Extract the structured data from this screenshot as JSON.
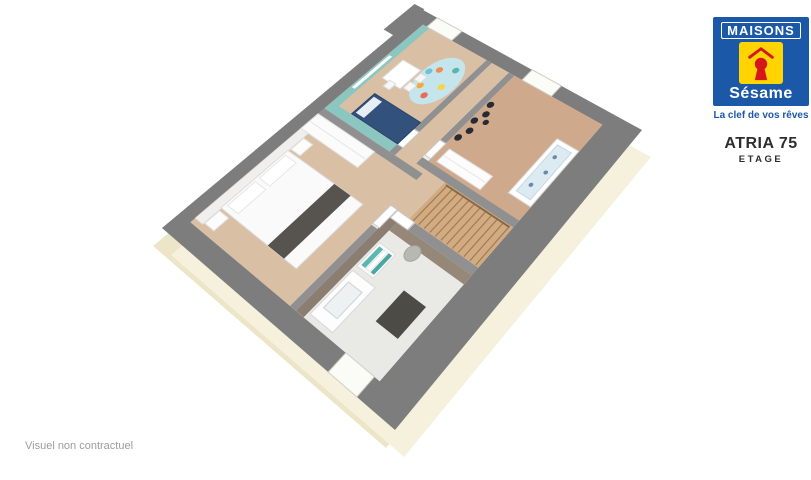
{
  "branding": {
    "maisons": "MAISONS",
    "sesame": "Sésame",
    "tagline": "La clef de vos rêves",
    "blue": "#1b59a8",
    "yellow": "#ffd400",
    "red": "#d6161d"
  },
  "model": {
    "name": "ATRIA 75",
    "level": "ETAGE"
  },
  "footer": {
    "disclaimer": "Visuel non contractuel"
  },
  "floorplan": {
    "canvas": {
      "width": 811,
      "height": 480
    },
    "projection": {
      "corners": {
        "A": [
          162,
          228
        ],
        "B": [
          423,
          10
        ],
        "C": [
          642,
          130
        ],
        "D": [
          395,
          430
        ]
      }
    },
    "shapes": [
      {
        "name": "facade-left-strip",
        "type": "quad-offset",
        "dx": -9,
        "dy": 18,
        "fill": "#ece5c8"
      },
      {
        "name": "facade-bottom-strip",
        "type": "quad-offset",
        "dx": 9,
        "dy": 27,
        "fill": "#f5f1dd"
      },
      {
        "name": "exterior-wall-band",
        "type": "rect",
        "u0": 0,
        "v0": 0,
        "u1": 1,
        "v1": 1,
        "fill": "#7d7d7d"
      },
      {
        "name": "exterior-wall-notch",
        "type": "rect",
        "u0": 0.86,
        "v0": -0.05,
        "u1": 1.005,
        "v1": 0.002,
        "fill": "#7d7d7d"
      },
      {
        "name": "floor-base",
        "type": "rect",
        "u0": 0.055,
        "v0": 0.055,
        "u1": 0.95,
        "v1": 0.88,
        "fill": "#ececea"
      },
      {
        "name": "master-bedroom-floor",
        "type": "rect",
        "u0": 0.055,
        "v0": 0.055,
        "u1": 0.5,
        "v1": 0.52,
        "fill": "#d9c0a5"
      },
      {
        "name": "master-headboard-wall",
        "type": "rect",
        "u0": 0.07,
        "v0": 0.055,
        "u1": 0.435,
        "v1": 0.092,
        "fill": "#f0efed",
        "stroke": "#e2e0dd",
        "w": 0.8
      },
      {
        "name": "kids-bedroom-floor",
        "type": "rect",
        "u0": 0.525,
        "v0": 0.055,
        "u1": 0.95,
        "v1": 0.37,
        "fill": "#d9c0a5"
      },
      {
        "name": "hallway-floor",
        "type": "rect",
        "u0": 0.525,
        "v0": 0.395,
        "u1": 0.95,
        "v1": 0.475,
        "fill": "#d9c0a5"
      },
      {
        "name": "landing-floor",
        "type": "rect",
        "u0": 0.4,
        "v0": 0.475,
        "u1": 0.565,
        "v1": 0.6,
        "fill": "#d9c0a5"
      },
      {
        "name": "nursery-floor",
        "type": "rect",
        "u0": 0.565,
        "v0": 0.5,
        "u1": 0.95,
        "v1": 0.88,
        "fill": "#cfa98b"
      },
      {
        "name": "bathroom-floor",
        "type": "rect",
        "u0": 0.055,
        "v0": 0.545,
        "u1": 0.375,
        "v1": 0.88,
        "fill": "#e9e9e6"
      },
      {
        "name": "staircase-floor",
        "type": "rect",
        "u0": 0.4,
        "v0": 0.6,
        "u1": 0.54,
        "v1": 0.88,
        "fill": "#d2ab82"
      },
      {
        "name": "kids-teal-wall-top",
        "type": "rect",
        "u0": 0.525,
        "v0": 0.055,
        "u1": 0.95,
        "v1": 0.088,
        "fill": "#8cc6c1"
      },
      {
        "name": "kids-teal-wall-side",
        "type": "rect",
        "u0": 0.525,
        "v0": 0.055,
        "u1": 0.556,
        "v1": 0.37,
        "fill": "#8cc6c1"
      },
      {
        "name": "kids-wall-shelf",
        "type": "rect",
        "u0": 0.63,
        "v0": 0.062,
        "u1": 0.79,
        "v1": 0.076,
        "fill": "#ffffff"
      },
      {
        "name": "bathroom-taupe-wall-top",
        "type": "rect",
        "u0": 0.055,
        "v0": 0.545,
        "u1": 0.375,
        "v1": 0.578,
        "fill": "#8b7e71"
      },
      {
        "name": "bathroom-taupe-wall-side",
        "type": "rect",
        "u0": 0.345,
        "v0": 0.578,
        "u1": 0.375,
        "v1": 0.88,
        "fill": "#958879"
      },
      {
        "name": "partition-master-kids",
        "type": "rect",
        "u0": 0.5,
        "v0": 0.055,
        "u1": 0.525,
        "v1": 0.52,
        "fill": "#909090"
      },
      {
        "name": "partition-kids-hall-a",
        "type": "rect",
        "u0": 0.525,
        "v0": 0.37,
        "u1": 0.556,
        "v1": 0.395,
        "fill": "#909090"
      },
      {
        "name": "partition-kids-hall-b",
        "type": "rect",
        "u0": 0.625,
        "v0": 0.37,
        "u1": 0.95,
        "v1": 0.395,
        "fill": "#909090"
      },
      {
        "name": "partition-hall-nursery",
        "type": "rect",
        "u0": 0.64,
        "v0": 0.475,
        "u1": 0.95,
        "v1": 0.5,
        "fill": "#909090"
      },
      {
        "name": "partition-stairwell",
        "type": "rect",
        "u0": 0.54,
        "v0": 0.475,
        "u1": 0.565,
        "v1": 0.88,
        "fill": "#909090"
      },
      {
        "name": "partition-master-landing",
        "type": "rect",
        "u0": 0.055,
        "v0": 0.52,
        "u1": 0.33,
        "v1": 0.545,
        "fill": "#909090"
      },
      {
        "name": "partition-bathroom-stairs",
        "type": "rect",
        "u0": 0.375,
        "v0": 0.625,
        "u1": 0.4,
        "v1": 0.88,
        "fill": "#909090"
      },
      {
        "name": "kids-window",
        "type": "rect",
        "u0": 0.95,
        "v0": 0.075,
        "u1": 1.0,
        "v1": 0.2,
        "fill": "#fcfcf7",
        "stroke": "#cfcfca",
        "w": 1
      },
      {
        "name": "nursery-window",
        "type": "rect",
        "u0": 0.95,
        "v0": 0.535,
        "u1": 1.0,
        "v1": 0.665,
        "fill": "#fcfcf7",
        "stroke": "#cfcfca",
        "w": 1
      },
      {
        "name": "bathroom-window",
        "type": "rect",
        "u0": 0.0,
        "v0": 0.75,
        "u1": 0.055,
        "v1": 0.86,
        "fill": "#fcfcf7",
        "stroke": "#cfcfca",
        "w": 1
      },
      {
        "name": "master-door",
        "type": "rect",
        "u0": 0.335,
        "v0": 0.519,
        "u1": 0.402,
        "v1": 0.547,
        "fill": "#ffffff",
        "stroke": "#c9c9c9",
        "w": 1
      },
      {
        "name": "kids-door",
        "type": "rect",
        "u0": 0.557,
        "v0": 0.369,
        "u1": 0.623,
        "v1": 0.396,
        "fill": "#ffffff",
        "stroke": "#c9c9c9",
        "w": 1
      },
      {
        "name": "nursery-door",
        "type": "rect",
        "u0": 0.575,
        "v0": 0.474,
        "u1": 0.638,
        "v1": 0.501,
        "fill": "#ffffff",
        "stroke": "#c9c9c9",
        "w": 1
      },
      {
        "name": "bathroom-door",
        "type": "rect",
        "u0": 0.374,
        "v0": 0.55,
        "u1": 0.401,
        "v1": 0.622,
        "fill": "#ffffff",
        "stroke": "#c9c9c9",
        "w": 1
      },
      {
        "name": "master-wardrobe",
        "type": "rect",
        "u0": 0.435,
        "v0": 0.055,
        "u1": 0.5,
        "v1": 0.33,
        "fill": "#fbfbfb",
        "stroke": "#e1e1e1",
        "w": 1
      },
      {
        "name": "master-wardrobe-door-line",
        "type": "line",
        "p1": [
          0.4675,
          0.06
        ],
        "p2": [
          0.4675,
          0.325
        ],
        "stroke": "#e6e6e6",
        "w": 1
      },
      {
        "name": "master-bed",
        "type": "rect",
        "u0": 0.13,
        "v0": 0.09,
        "u1": 0.36,
        "v1": 0.445,
        "fill": "#fafafa",
        "stroke": "#dcdcdc",
        "w": 1
      },
      {
        "name": "master-bed-pillow-left",
        "type": "rect",
        "u0": 0.145,
        "v0": 0.1,
        "u1": 0.238,
        "v1": 0.152,
        "fill": "#ffffff",
        "stroke": "#e6e6e6",
        "w": 1
      },
      {
        "name": "master-bed-pillow-right",
        "type": "rect",
        "u0": 0.252,
        "v0": 0.1,
        "u1": 0.345,
        "v1": 0.152,
        "fill": "#ffffff",
        "stroke": "#e6e6e6",
        "w": 1
      },
      {
        "name": "master-bed-runner",
        "type": "rect",
        "u0": 0.13,
        "v0": 0.315,
        "u1": 0.36,
        "v1": 0.39,
        "fill": "#57544f"
      },
      {
        "name": "master-nightstand-left",
        "type": "rect",
        "u0": 0.075,
        "v0": 0.095,
        "u1": 0.122,
        "v1": 0.14,
        "fill": "#fcfcfc",
        "stroke": "#e0e0e0",
        "w": 1
      },
      {
        "name": "master-nightstand-right",
        "type": "rect",
        "u0": 0.368,
        "v0": 0.095,
        "u1": 0.415,
        "v1": 0.14,
        "fill": "#fcfcfc",
        "stroke": "#e0e0e0",
        "w": 1
      },
      {
        "name": "kids-bed",
        "type": "rect",
        "u0": 0.558,
        "v0": 0.15,
        "u1": 0.652,
        "v1": 0.37,
        "fill": "#32517d",
        "stroke": "#2a4369",
        "w": 1
      },
      {
        "name": "kids-bed-pillow",
        "type": "rect",
        "u0": 0.568,
        "v0": 0.158,
        "u1": 0.642,
        "v1": 0.198,
        "fill": "#e9eef5"
      },
      {
        "name": "kids-rug",
        "type": "ellipse",
        "c": [
          0.8,
          0.29
        ],
        "r": [
          0.105,
          0.075
        ],
        "fill": "#c3e5eb"
      },
      {
        "name": "kids-rug-dot",
        "type": "circle",
        "c": [
          0.755,
          0.255
        ],
        "rr": 0.012,
        "fill": "#f2a93b"
      },
      {
        "name": "kids-rug-dot",
        "type": "circle",
        "c": [
          0.835,
          0.262
        ],
        "rr": 0.012,
        "fill": "#ef8d4e"
      },
      {
        "name": "kids-rug-dot",
        "type": "circle",
        "c": [
          0.787,
          0.322
        ],
        "rr": 0.012,
        "fill": "#ffd23f"
      },
      {
        "name": "kids-rug-dot",
        "type": "circle",
        "c": [
          0.862,
          0.312
        ],
        "rr": 0.012,
        "fill": "#57b7b0"
      },
      {
        "name": "kids-rug-dot",
        "type": "circle",
        "c": [
          0.733,
          0.298
        ],
        "rr": 0.012,
        "fill": "#e96a5a"
      },
      {
        "name": "kids-rug-dot",
        "type": "circle",
        "c": [
          0.812,
          0.235
        ],
        "rr": 0.012,
        "fill": "#6fc3d9"
      },
      {
        "name": "kids-play-table",
        "type": "rect",
        "u0": 0.71,
        "v0": 0.12,
        "u1": 0.8,
        "v1": 0.208,
        "fill": "#ffffff",
        "stroke": "#dddddd",
        "w": 1
      },
      {
        "name": "kids-chair",
        "type": "rect",
        "u0": 0.718,
        "v0": 0.215,
        "u1": 0.748,
        "v1": 0.245,
        "fill": "#f7f7f7",
        "stroke": "#dddddd",
        "w": 1
      },
      {
        "name": "kids-chair",
        "type": "rect",
        "u0": 0.762,
        "v0": 0.218,
        "u1": 0.792,
        "v1": 0.248,
        "fill": "#f7f7f7",
        "stroke": "#dddddd",
        "w": 1
      },
      {
        "name": "kids-chair",
        "type": "rect",
        "u0": 0.688,
        "v0": 0.15,
        "u1": 0.716,
        "v1": 0.18,
        "fill": "#f7f7f7",
        "stroke": "#dddddd",
        "w": 1
      },
      {
        "name": "nursery-wardrobe",
        "type": "rect",
        "u0": 0.578,
        "v0": 0.525,
        "u1": 0.63,
        "v1": 0.71,
        "fill": "#fcfcfc",
        "stroke": "#e0e0e0",
        "w": 1
      },
      {
        "name": "nursery-wardrobe-door-line",
        "type": "line",
        "p1": [
          0.604,
          0.53
        ],
        "p2": [
          0.604,
          0.705
        ],
        "stroke": "#e6e6e6",
        "w": 1
      },
      {
        "name": "nursery-wall-decal",
        "type": "circle",
        "c": [
          0.675,
          0.517
        ],
        "rr": 0.012,
        "fill": "#262b33"
      },
      {
        "name": "nursery-wall-decal",
        "type": "circle",
        "c": [
          0.712,
          0.53
        ],
        "rr": 0.012,
        "fill": "#262b33"
      },
      {
        "name": "nursery-wall-decal",
        "type": "circle",
        "c": [
          0.748,
          0.515
        ],
        "rr": 0.012,
        "fill": "#262b33"
      },
      {
        "name": "nursery-wall-decal",
        "type": "circle",
        "c": [
          0.785,
          0.53
        ],
        "rr": 0.012,
        "fill": "#262b33"
      },
      {
        "name": "nursery-wall-decal",
        "type": "circle",
        "c": [
          0.82,
          0.516
        ],
        "rr": 0.012,
        "fill": "#262b33"
      },
      {
        "name": "nursery-wall-decal",
        "type": "circle",
        "c": [
          0.762,
          0.552
        ],
        "rr": 0.01,
        "fill": "#262b33"
      },
      {
        "name": "nursery-crib-frame",
        "type": "rect",
        "u0": 0.615,
        "v0": 0.79,
        "u1": 0.835,
        "v1": 0.878,
        "fill": "#ffffff",
        "stroke": "#d9d9d9",
        "w": 1
      },
      {
        "name": "nursery-crib-mattress",
        "type": "rect",
        "u0": 0.632,
        "v0": 0.806,
        "u1": 0.818,
        "v1": 0.862,
        "fill": "#dceaf2",
        "stroke": "#c6d8e4",
        "w": 1
      },
      {
        "name": "nursery-crib-dot",
        "type": "circle",
        "c": [
          0.67,
          0.83
        ],
        "rr": 0.007,
        "fill": "#6b88a6"
      },
      {
        "name": "nursery-crib-dot",
        "type": "circle",
        "c": [
          0.725,
          0.84
        ],
        "rr": 0.007,
        "fill": "#6b88a6"
      },
      {
        "name": "nursery-crib-dot",
        "type": "circle",
        "c": [
          0.78,
          0.828
        ],
        "rr": 0.007,
        "fill": "#6b88a6"
      },
      {
        "name": "bathroom-vanity",
        "type": "rect",
        "u0": 0.07,
        "v0": 0.585,
        "u1": 0.21,
        "v1": 0.678,
        "fill": "#fdfdfd",
        "stroke": "#d8d8d8",
        "w": 1
      },
      {
        "name": "bathroom-sink-basin",
        "type": "rect",
        "u0": 0.1,
        "v0": 0.602,
        "u1": 0.182,
        "v1": 0.658,
        "fill": "#eef1f2",
        "stroke": "#ccd2d5",
        "w": 1
      },
      {
        "name": "bathroom-shelf",
        "type": "rect",
        "u0": 0.225,
        "v0": 0.585,
        "u1": 0.305,
        "v1": 0.652,
        "fill": "#fbfbfb",
        "stroke": "#dddddd",
        "w": 1
      },
      {
        "name": "bathroom-towel",
        "type": "rect",
        "u0": 0.233,
        "v0": 0.593,
        "u1": 0.297,
        "v1": 0.609,
        "fill": "#5bb8b0"
      },
      {
        "name": "bathroom-towel",
        "type": "rect",
        "u0": 0.233,
        "v0": 0.613,
        "u1": 0.297,
        "v1": 0.628,
        "fill": "#ffffff",
        "stroke": "#e0e0e0",
        "w": 0.8
      },
      {
        "name": "bathroom-towel",
        "type": "rect",
        "u0": 0.233,
        "v0": 0.632,
        "u1": 0.297,
        "v1": 0.646,
        "fill": "#49a7a0"
      },
      {
        "name": "bathroom-laundry-basket",
        "type": "circle",
        "c": [
          0.332,
          0.69
        ],
        "rr": 0.023,
        "fill": "#b8b8b2",
        "stroke": "#a5a59e",
        "w": 1
      },
      {
        "name": "bathroom-mat",
        "type": "rect",
        "u0": 0.15,
        "v0": 0.752,
        "u1": 0.247,
        "v1": 0.838,
        "fill": "#4c4b45"
      },
      {
        "name": "stair-treads",
        "type": "treads",
        "u0": 0.402,
        "v0": 0.615,
        "u1": 0.538,
        "v1": 0.868,
        "count": 12,
        "stroke": "#a07c50",
        "w": 1.2
      },
      {
        "name": "stair-handrail",
        "type": "line",
        "p1": [
          0.535,
          0.61
        ],
        "p2": [
          0.535,
          0.87
        ],
        "stroke": "#8a6a45",
        "w": 2
      }
    ]
  }
}
